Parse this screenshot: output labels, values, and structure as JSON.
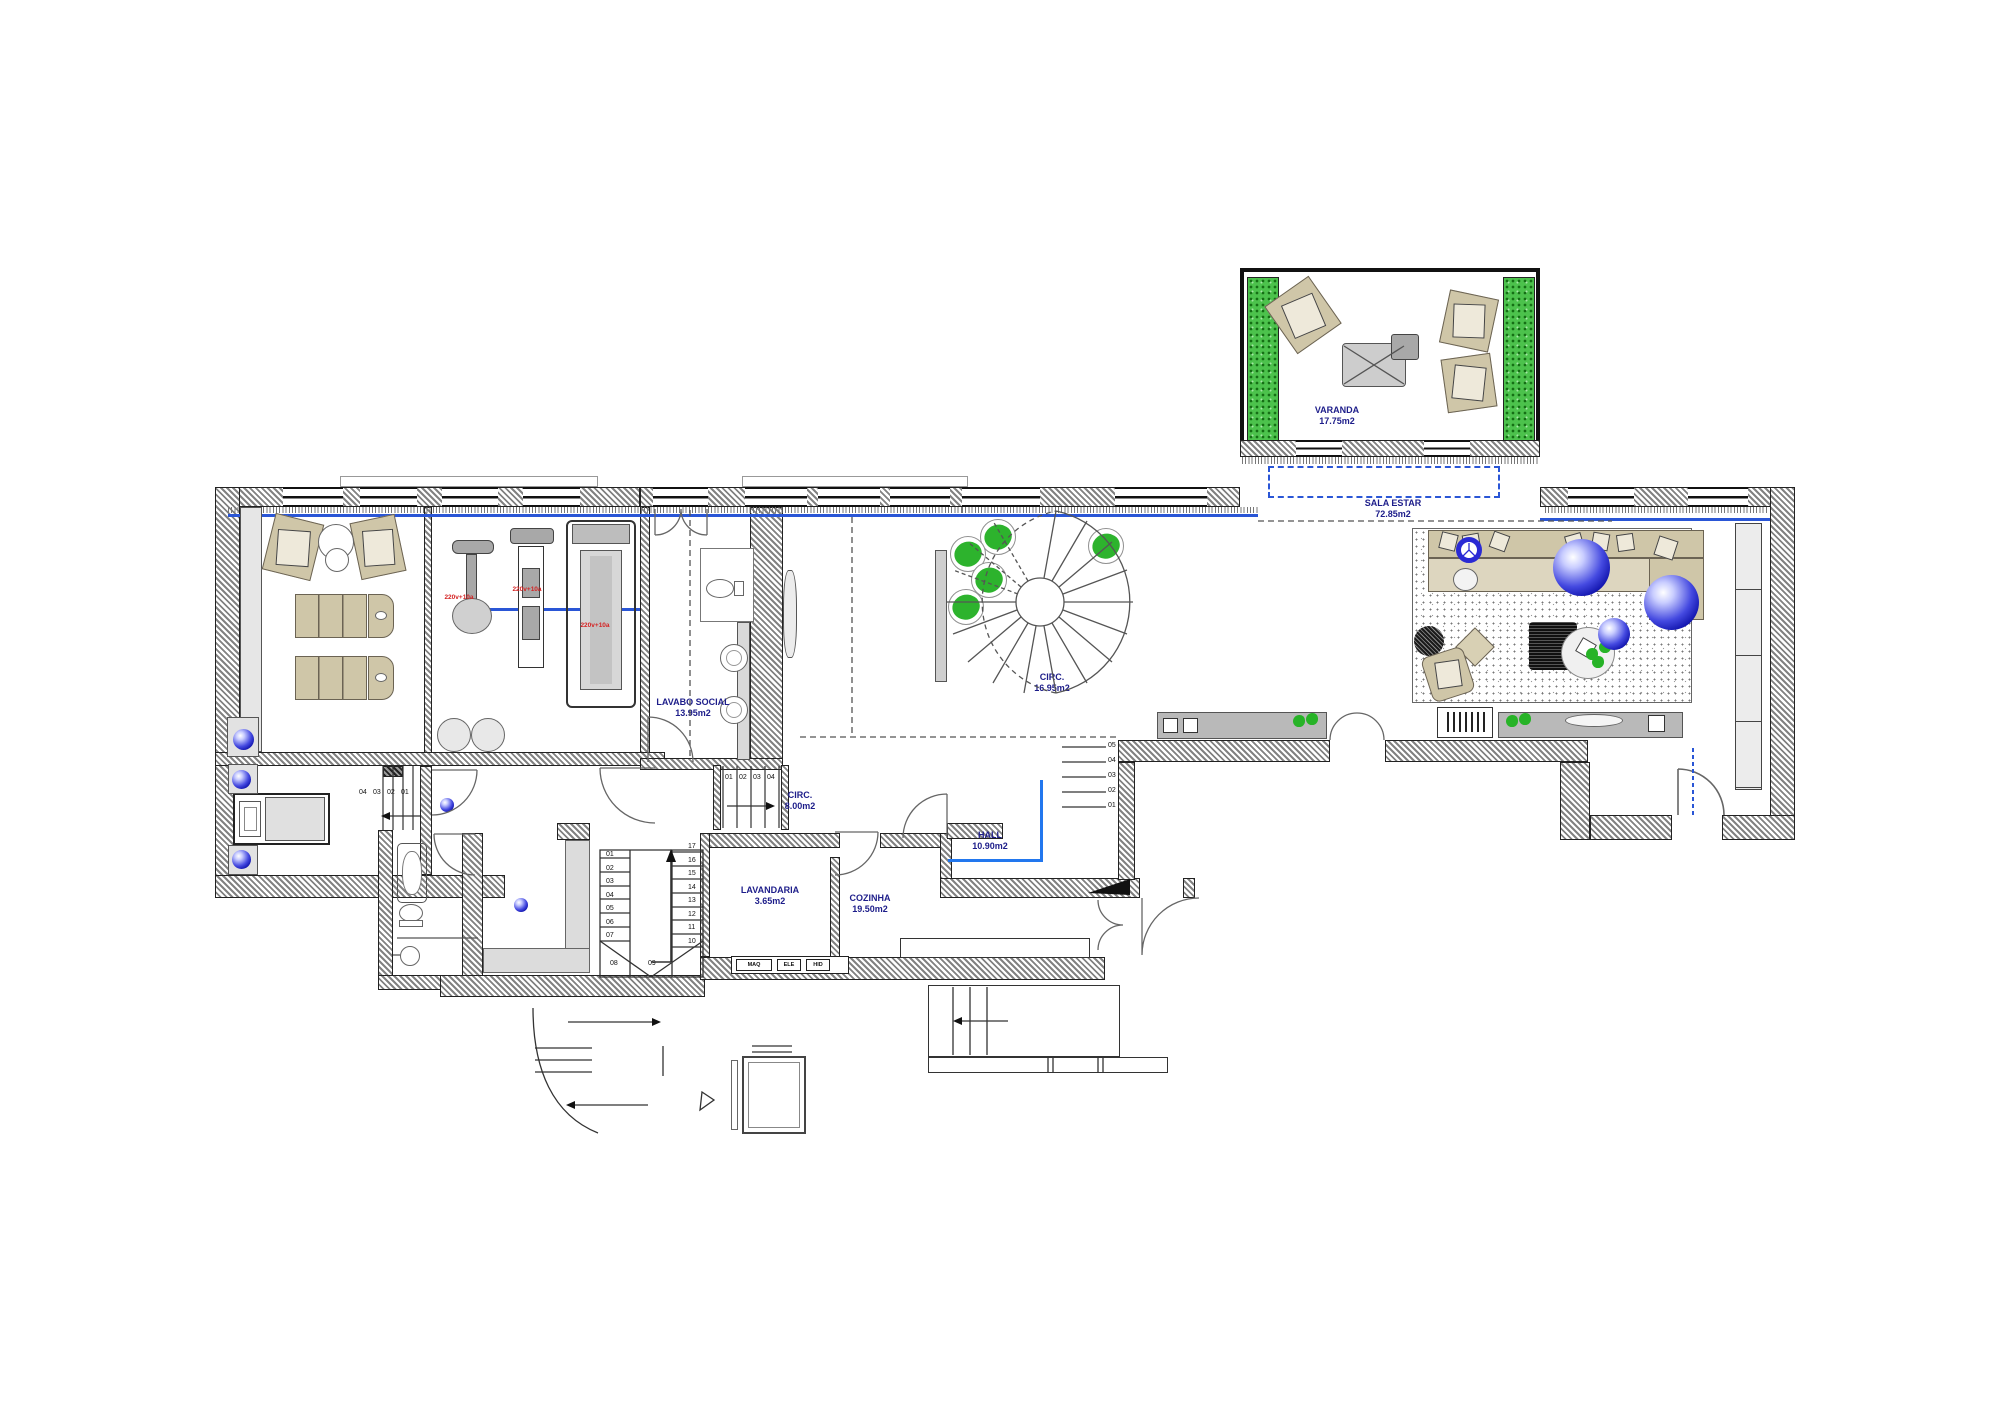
{
  "rooms": {
    "varanda": {
      "label": "VARANDA",
      "area": "17.75m2"
    },
    "sala_estar": {
      "label": "SALA ESTAR",
      "area": "72.85m2"
    },
    "circ_main": {
      "label": "CIRC.",
      "area": "16.95m2"
    },
    "lavabo_social": {
      "label": "LAVABO SOCIAL",
      "area": "13.95m2"
    },
    "circ_service": {
      "label": "CIRC.",
      "area": "8.00m2"
    },
    "lavandaria": {
      "label": "LAVANDARIA",
      "area": "3.65m2"
    },
    "cozinha": {
      "label": "COZINHA",
      "area": "19.50m2"
    },
    "hall": {
      "label": "HALL",
      "area": "10.90m2"
    }
  },
  "stairs": {
    "main": {
      "left": [
        "01",
        "02",
        "03",
        "04",
        "05",
        "06",
        "07"
      ],
      "right": [
        "17",
        "16",
        "15",
        "14",
        "13",
        "12",
        "11",
        "10"
      ],
      "winders": [
        "08",
        "09"
      ]
    },
    "hall_steps": [
      "05",
      "04",
      "03",
      "02",
      "01"
    ],
    "service_steps": [
      "01",
      "02",
      "03",
      "04"
    ],
    "bedroom_steps": [
      "04",
      "03",
      "02",
      "01"
    ]
  },
  "gym": {
    "outlet_labels": [
      "220v+10a",
      "220v+10a",
      "220v+10a"
    ]
  },
  "kitchen": {
    "panel_labels": [
      "MAQ",
      "ELE",
      "HID"
    ]
  },
  "colors": {
    "label_navy": "#1d1d8a",
    "accent_blue": "#2a56d6",
    "sphere_blue": "#1114ad",
    "plant_green": "#2db32d",
    "hedge_green": "#4cc24c",
    "outlet_red": "#d42222",
    "wall_gray": "#828282"
  }
}
